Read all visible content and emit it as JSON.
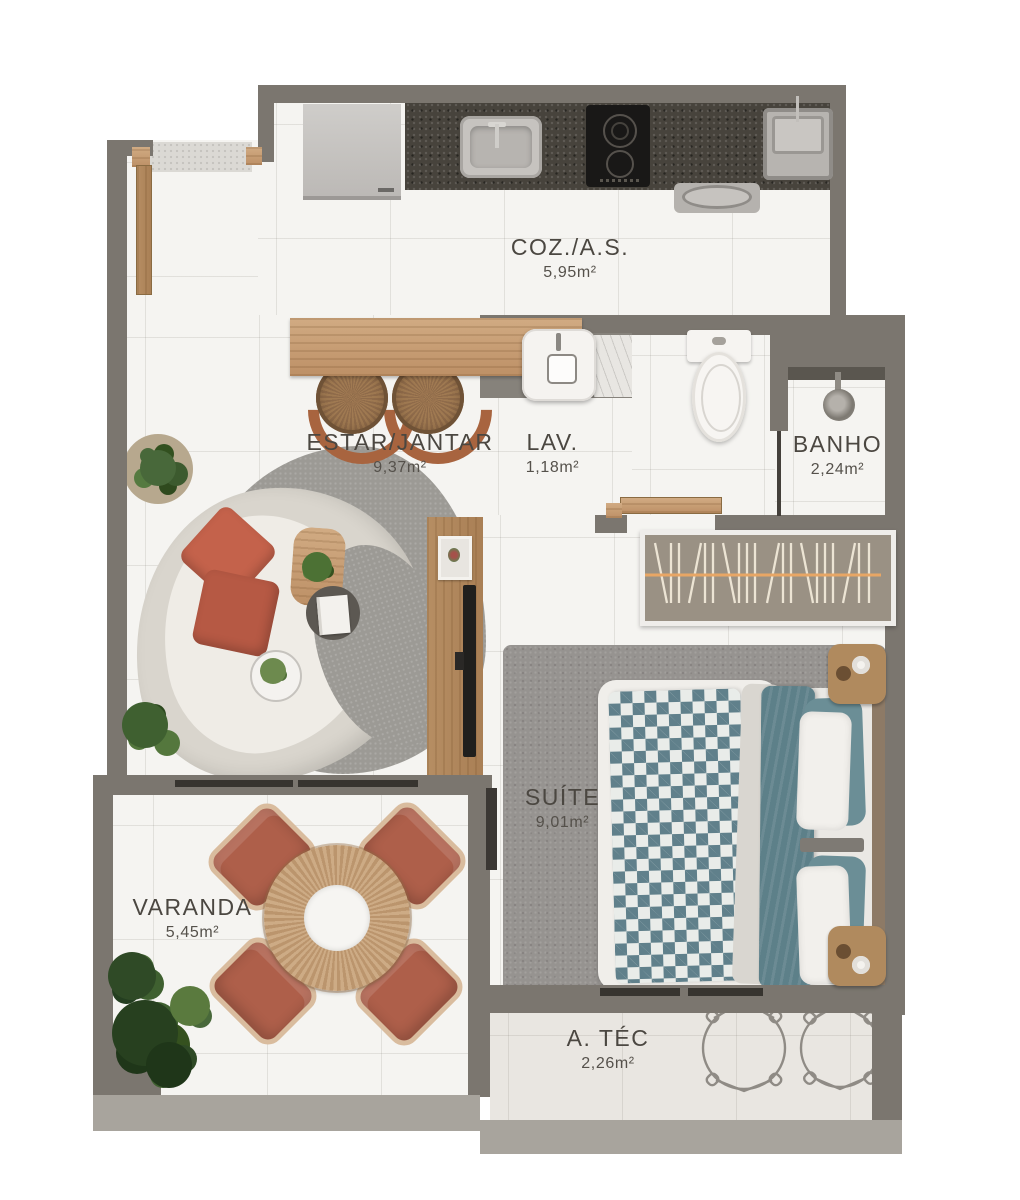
{
  "plan": {
    "type": "apartment-floor-plan",
    "rooms": {
      "coz": {
        "name": "COZ./A.S.",
        "area": "5,95m²"
      },
      "estar": {
        "name": "ESTAR/JANTAR",
        "area": "9,37m²"
      },
      "lav": {
        "name": "LAV.",
        "area": "1,18m²"
      },
      "banho": {
        "name": "BANHO",
        "area": "2,24m²"
      },
      "suite": {
        "name": "SUÍTE",
        "area": "9,01m²"
      },
      "varanda": {
        "name": "VARANDA",
        "area": "5,45m²"
      },
      "atec": {
        "name": "A. TÉC",
        "area": "2,26m²"
      }
    },
    "colors": {
      "wall": "#7b766f",
      "wall_light": "#a8a49d",
      "floor": "#f5f4f1",
      "counter_granite": "#47433c",
      "wood": "#c9a47c",
      "terracotta": "#ae5f4a",
      "rug_gray": "#9c9a95",
      "bed_teal": "#5d8089",
      "sofa_cream": "#e8e5de",
      "art_orange": "#e8a665"
    }
  }
}
